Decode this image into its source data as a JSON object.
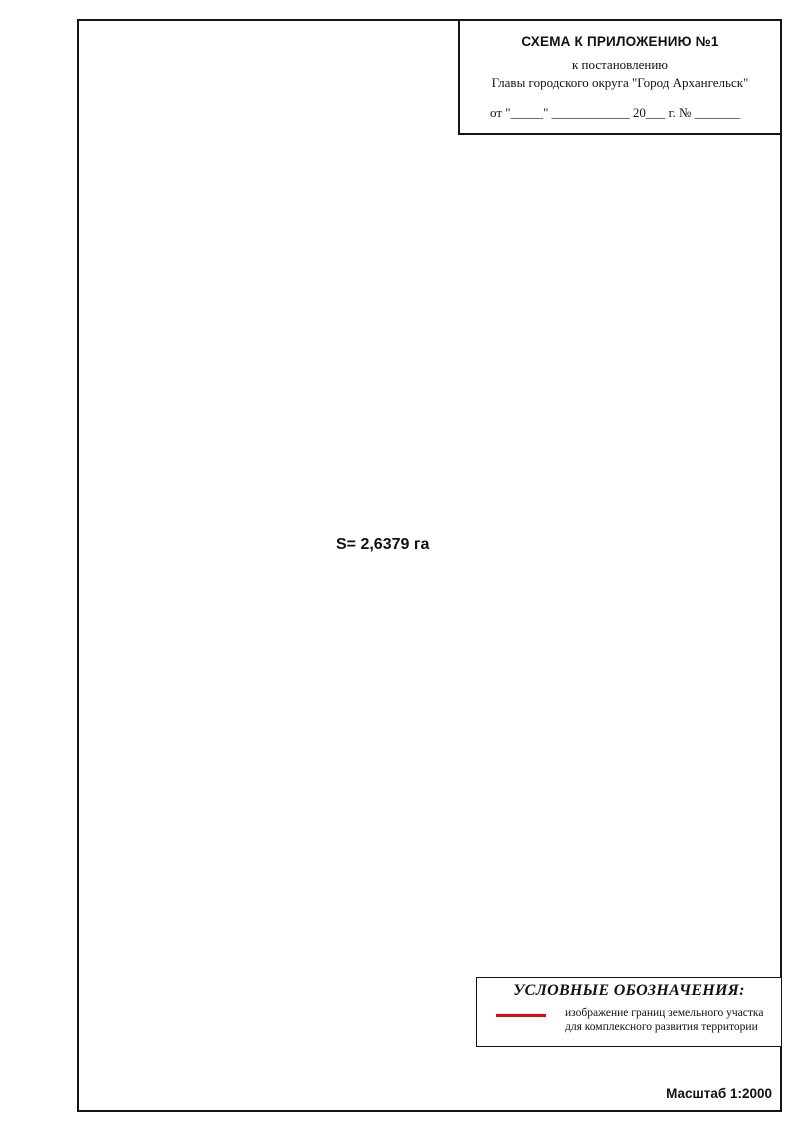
{
  "title_block": {
    "line1": "СХЕМА К ПРИЛОЖЕНИЮ №1",
    "line2": "к постановлению",
    "line3": "Главы городского округа \"Город Архангельск\"",
    "line4": "от \"_____\" ____________ 20___ г. № _______"
  },
  "legend": {
    "title": "УСЛОВНЫЕ ОБОЗНАЧЕНИЯ:",
    "item": {
      "symbol": "red-boundary-line",
      "line1": "изображение границ земельного участка",
      "line2": "для комплексного развития территории"
    }
  },
  "scale_label": "Масштаб 1:2000",
  "map": {
    "area_label": "S= 2,6379 га",
    "north": {
      "label": "С"
    },
    "colors": {
      "boundary": "#e30613",
      "parcel_line": "#bf4a43",
      "building_fill": "#edecea",
      "building_stroke": "#a8a8a8",
      "building_red_stroke": "#c0403e",
      "pale_stroke": "#cccccc",
      "label_text": "#3c3c3c"
    },
    "boundary": {
      "width": 4.5,
      "points": [
        [
          183,
          549
        ],
        [
          158,
          517
        ],
        [
          156,
          505
        ],
        [
          348,
          344
        ],
        [
          511,
          556
        ],
        [
          558,
          611
        ],
        [
          586,
          661
        ],
        [
          589,
          667
        ],
        [
          575,
          676
        ],
        [
          513,
          724
        ],
        [
          495,
          693
        ],
        [
          463,
          721
        ],
        [
          479,
          751
        ],
        [
          411,
          807
        ],
        [
          385,
          773
        ],
        [
          323,
          700
        ],
        [
          265,
          642
        ]
      ],
      "vertex_labels": [
        {
          "n": "1",
          "x": 183,
          "y": 560
        },
        {
          "n": "2",
          "x": 147,
          "y": 521
        },
        {
          "n": "3",
          "x": 140,
          "y": 502
        },
        {
          "n": "4",
          "x": 349,
          "y": 334
        },
        {
          "n": "5",
          "x": 521,
          "y": 537
        },
        {
          "n": "6",
          "x": 566,
          "y": 608
        },
        {
          "n": "7",
          "x": 592,
          "y": 649
        },
        {
          "n": "8",
          "x": 599,
          "y": 674
        },
        {
          "n": "9",
          "x": 582,
          "y": 685
        },
        {
          "n": "10",
          "x": 526,
          "y": 734
        },
        {
          "n": "11",
          "x": 492,
          "y": 712
        },
        {
          "n": "12",
          "x": 477,
          "y": 727
        },
        {
          "n": "13",
          "x": 495,
          "y": 760
        },
        {
          "n": "14",
          "x": 416,
          "y": 824
        },
        {
          "n": "15",
          "x": 369,
          "y": 777
        },
        {
          "n": "16",
          "x": 310,
          "y": 710
        },
        {
          "n": "17",
          "x": 245,
          "y": 633
        }
      ]
    },
    "streets": [
      {
        "name": "ул. Чкалова",
        "x": 252,
        "y": 410,
        "rot": -40,
        "size": 8
      },
      {
        "name": "ул. Калинина",
        "x": 160,
        "y": 549,
        "rot": 52,
        "size": 8
      },
      {
        "name": "ул. Республиканская",
        "x": 215,
        "y": 278,
        "rot": 52,
        "size": 8
      },
      {
        "name": "ул. Республиканская",
        "x": 477,
        "y": 503,
        "rot": 55,
        "size": 8
      },
      {
        "name": "ул. Почтовая",
        "x": 344,
        "y": 162,
        "rot": 52,
        "size": 8
      },
      {
        "name": "ул. Почтовая",
        "x": 586,
        "y": 457,
        "rot": 62,
        "size": 8
      },
      {
        "name": "ул. Почтовая",
        "x": 711,
        "y": 687,
        "rot": 66,
        "size": 8
      },
      {
        "name": "ул. Героя Советского Союза Петра Лушева",
        "x": 276,
        "y": 946,
        "rot": -39,
        "size": 7.5
      },
      {
        "name": "ул. Героя Советского Союза Петра Лушева",
        "x": 124,
        "y": 1075,
        "rot": -39,
        "size": 7.5
      }
    ],
    "buildings": [
      [
        337,
        372,
        46,
        26,
        -38,
        "14",
        "g"
      ],
      [
        288,
        440,
        66,
        30,
        -38,
        "12",
        "g"
      ],
      [
        385,
        438,
        74,
        28,
        52,
        "12",
        "g"
      ],
      [
        214,
        492,
        68,
        30,
        -38,
        "10",
        "g"
      ],
      [
        235,
        570,
        64,
        30,
        -38,
        "11",
        "g"
      ],
      [
        443,
        630,
        54,
        26,
        52,
        "13",
        "g"
      ],
      [
        360,
        722,
        54,
        28,
        52,
        "15",
        "g"
      ],
      [
        437,
        770,
        56,
        28,
        52,
        "17",
        "g"
      ],
      [
        509,
        597,
        58,
        26,
        52,
        "16",
        "g"
      ],
      [
        457,
        650,
        62,
        24,
        52,
        "16к.1",
        "g"
      ],
      [
        487,
        722,
        24,
        16,
        52,
        "17к.1",
        "r"
      ],
      [
        230,
        377,
        56,
        26,
        -38,
        "13",
        "g"
      ],
      [
        340,
        296,
        44,
        24,
        -38,
        "15",
        "g"
      ],
      [
        160,
        452,
        42,
        22,
        -38,
        "11",
        "g"
      ],
      [
        95,
        506,
        32,
        20,
        -38,
        "9",
        "g"
      ],
      [
        97,
        412,
        40,
        22,
        52,
        "7",
        "g"
      ],
      [
        125,
        255,
        28,
        52,
        52,
        "6",
        "g"
      ],
      [
        145,
        152,
        26,
        44,
        52,
        "5",
        "g"
      ],
      [
        207,
        46,
        32,
        46,
        52,
        "",
        "g"
      ],
      [
        125,
        71,
        18,
        14,
        -38,
        "",
        "g"
      ],
      [
        310,
        158,
        32,
        46,
        52,
        "8",
        "g"
      ],
      [
        347,
        133,
        42,
        24,
        -38,
        "7",
        "g"
      ],
      [
        358,
        62,
        34,
        40,
        52,
        "5к.1",
        "r"
      ],
      [
        388,
        180,
        58,
        28,
        52,
        "2к.1",
        "r"
      ],
      [
        420,
        222,
        36,
        22,
        52,
        "9",
        "g"
      ],
      [
        382,
        256,
        50,
        30,
        52,
        "17",
        "g"
      ],
      [
        462,
        412,
        56,
        28,
        -38,
        "11",
        "g"
      ],
      [
        413,
        350,
        40,
        26,
        -38,
        "14к.1",
        "r"
      ],
      [
        500,
        410,
        22,
        14,
        52,
        "19стр.1",
        "r"
      ],
      [
        470,
        198,
        64,
        24,
        -38,
        "10",
        "g"
      ],
      [
        497,
        160,
        30,
        18,
        52,
        "10к.1",
        "g"
      ],
      [
        610,
        172,
        78,
        26,
        -38,
        "20",
        "r"
      ],
      [
        623,
        209,
        22,
        13,
        -38,
        "20к1а.1",
        "r"
      ],
      [
        648,
        282,
        70,
        26,
        62,
        "16",
        "r"
      ],
      [
        700,
        186,
        46,
        22,
        52,
        "16к.1",
        "r"
      ],
      [
        716,
        256,
        58,
        26,
        62,
        "",
        "r"
      ],
      [
        750,
        318,
        54,
        26,
        62,
        "18к.2",
        "r"
      ],
      [
        537,
        340,
        58,
        24,
        52,
        "11",
        "g"
      ],
      [
        588,
        404,
        24,
        14,
        52,
        "11стр.1",
        "r"
      ],
      [
        625,
        438,
        64,
        24,
        52,
        "13",
        "r"
      ],
      [
        652,
        476,
        62,
        24,
        52,
        "15",
        "g"
      ],
      [
        680,
        512,
        60,
        24,
        52,
        "17",
        "g"
      ],
      [
        702,
        550,
        58,
        24,
        52,
        "19",
        "g"
      ],
      [
        556,
        538,
        40,
        22,
        52,
        "15",
        "g"
      ],
      [
        608,
        360,
        48,
        22,
        52,
        "",
        "g"
      ],
      [
        745,
        700,
        84,
        32,
        52,
        "",
        "g"
      ],
      [
        705,
        741,
        44,
        26,
        52,
        "21",
        "r"
      ],
      [
        735,
        820,
        28,
        18,
        52,
        "21к.1стр.1",
        "r"
      ],
      [
        768,
        940,
        56,
        36,
        52,
        "21к.1",
        "r"
      ],
      [
        563,
        870,
        112,
        38,
        52,
        "19",
        "g"
      ],
      [
        452,
        940,
        58,
        28,
        52,
        "12",
        "r"
      ],
      [
        383,
        958,
        54,
        32,
        52,
        "14к.1",
        "g"
      ],
      [
        562,
        972,
        72,
        26,
        52,
        "19к.1",
        "r"
      ],
      [
        312,
        848,
        92,
        36,
        52,
        "167к.3",
        "r"
      ],
      [
        240,
        916,
        118,
        36,
        52,
        "167к.6",
        "r"
      ],
      [
        112,
        1012,
        68,
        30,
        52,
        "167",
        "r"
      ],
      [
        112,
        946,
        18,
        13,
        52,
        "167стр.1",
        "r"
      ],
      [
        225,
        796,
        84,
        34,
        52,
        "167к.2",
        "r"
      ],
      [
        115,
        776,
        78,
        36,
        52,
        "",
        "g"
      ],
      [
        170,
        608,
        76,
        32,
        52,
        "10",
        "g"
      ],
      [
        105,
        645,
        44,
        26,
        -38,
        "10к.1",
        "g"
      ],
      [
        455,
        612,
        62,
        30,
        52,
        "",
        "p"
      ],
      [
        700,
        622,
        60,
        26,
        52,
        "",
        "p"
      ],
      [
        545,
        205,
        36,
        20,
        52,
        "",
        "p"
      ]
    ],
    "parcel_lines": [
      [
        [
          63,
          524
        ],
        [
          420,
          224
        ]
      ],
      [
        [
          63,
          584
        ],
        [
          152,
          508
        ]
      ],
      [
        [
          350,
          342
        ],
        [
          432,
          272
        ]
      ],
      [
        [
          68,
          492
        ],
        [
          320,
          700
        ]
      ],
      [
        [
          413,
          809
        ],
        [
          63,
          1089
        ]
      ],
      [
        [
          378,
          322
        ],
        [
          606,
          620
        ]
      ],
      [
        [
          588,
          662
        ],
        [
          790,
          502
        ]
      ],
      [
        [
          115,
          1124
        ],
        [
          792,
          576
        ]
      ],
      [
        [
          548,
          352
        ],
        [
          608,
          498
        ],
        [
          700,
          692
        ]
      ],
      [
        [
          585,
          345
        ],
        [
          648,
          502
        ],
        [
          738,
          684
        ]
      ],
      [
        [
          63,
          352
        ],
        [
          238,
          206
        ]
      ],
      [
        [
          63,
          300
        ],
        [
          196,
          188
        ]
      ],
      [
        [
          96,
          160
        ],
        [
          226,
          48
        ]
      ],
      [
        [
          172,
          22
        ],
        [
          348,
          238
        ]
      ],
      [
        [
          250,
          24
        ],
        [
          420,
          250
        ]
      ],
      [
        [
          480,
          260
        ],
        [
          640,
          140
        ]
      ],
      [
        [
          560,
          320
        ],
        [
          760,
          162
        ]
      ],
      [
        [
          660,
          140
        ],
        [
          780,
          240
        ]
      ],
      [
        [
          205,
          520
        ],
        [
          420,
          695
        ]
      ],
      [
        [
          600,
          430
        ],
        [
          740,
          318
        ]
      ],
      [
        [
          640,
          530
        ],
        [
          770,
          424
        ]
      ],
      [
        [
          282,
          792
        ],
        [
          420,
          962
        ]
      ],
      [
        [
          175,
          878
        ],
        [
          300,
          1030
        ]
      ],
      [
        [
          82,
          864
        ],
        [
          206,
          1016
        ]
      ],
      [
        [
          430,
          1092
        ],
        [
          720,
          858
        ]
      ],
      [
        [
          660,
          812
        ],
        [
          792,
          706
        ]
      ],
      [
        [
          63,
          700
        ],
        [
          150,
          772
        ]
      ],
      [
        [
          63,
          618
        ],
        [
          158,
          696
        ]
      ]
    ]
  }
}
